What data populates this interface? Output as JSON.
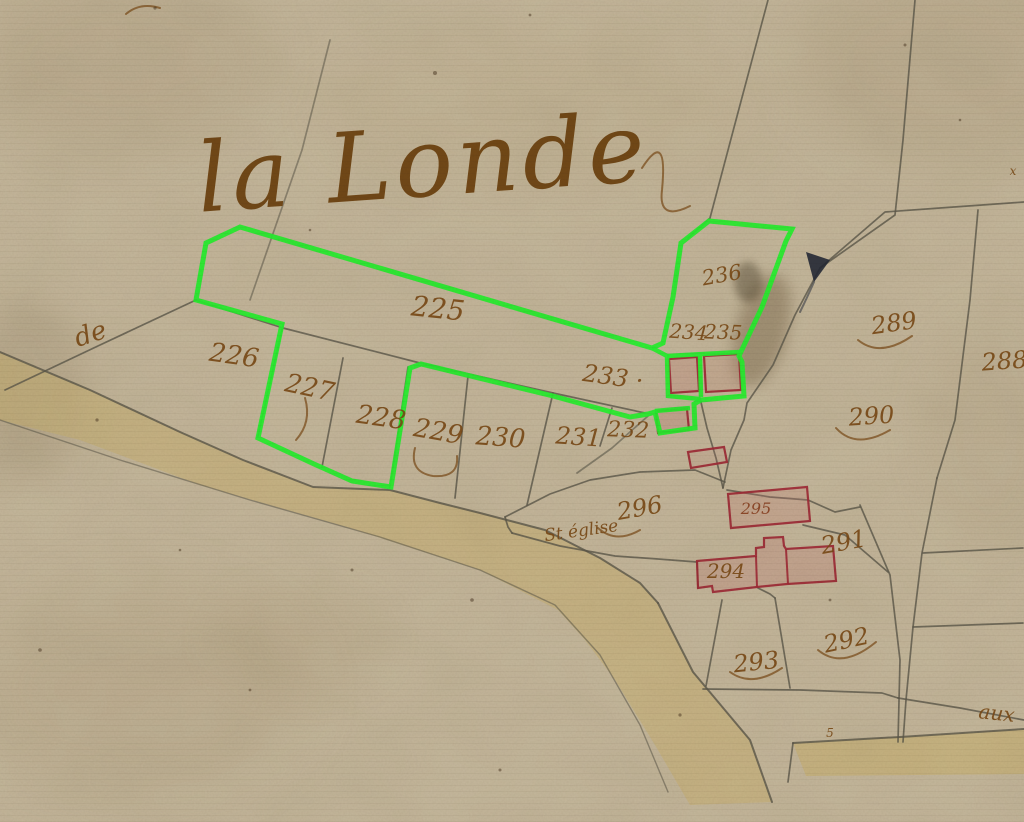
{
  "map": {
    "title": "la Londe",
    "colors": {
      "paper": "#c6b99e",
      "line": "#5c594b",
      "green": "#26f32e",
      "red": "#a12a36",
      "redFill": "#c47a74",
      "ink": "#7b4a15",
      "title_ink": "#6f4410",
      "road": "#c9b26a",
      "blot": "#252a36"
    },
    "labels": [
      {
        "id": "title",
        "text": "la Londe",
        "x": 425,
        "y": 196,
        "size": 96,
        "rot": -4,
        "color": "#6f4410",
        "cls": "lbl-title"
      },
      {
        "id": "de",
        "text": "de",
        "x": 93,
        "y": 342,
        "size": 26,
        "rot": -18
      },
      {
        "id": "p225",
        "text": "225",
        "x": 437,
        "y": 318,
        "size": 28,
        "rot": 6
      },
      {
        "id": "p226",
        "text": "226",
        "x": 233,
        "y": 364,
        "size": 26,
        "rot": 8
      },
      {
        "id": "p227",
        "text": "227",
        "x": 308,
        "y": 396,
        "size": 26,
        "rot": 12
      },
      {
        "id": "p228",
        "text": "228",
        "x": 380,
        "y": 426,
        "size": 26,
        "rot": 8
      },
      {
        "id": "p229",
        "text": "229",
        "x": 437,
        "y": 440,
        "size": 26,
        "rot": 10
      },
      {
        "id": "p230",
        "text": "230",
        "x": 500,
        "y": 446,
        "size": 26,
        "rot": 4
      },
      {
        "id": "p231",
        "text": "231",
        "x": 578,
        "y": 445,
        "size": 24,
        "rot": 4
      },
      {
        "id": "p232",
        "text": "232",
        "x": 628,
        "y": 437,
        "size": 22,
        "rot": 2
      },
      {
        "id": "p233",
        "text": "233 ·",
        "x": 612,
        "y": 385,
        "size": 24,
        "rot": 8
      },
      {
        "id": "p234",
        "text": "234",
        "x": 688,
        "y": 339,
        "size": 20,
        "rot": 4
      },
      {
        "id": "p235",
        "text": "235",
        "x": 723,
        "y": 339,
        "size": 20,
        "rot": 2
      },
      {
        "id": "p236",
        "text": "236",
        "x": 723,
        "y": 282,
        "size": 21,
        "rot": -10
      },
      {
        "id": "p288",
        "text": "288",
        "x": 1005,
        "y": 369,
        "size": 24,
        "rot": -4
      },
      {
        "id": "p289",
        "text": "289",
        "x": 895,
        "y": 331,
        "size": 24,
        "rot": -8
      },
      {
        "id": "p290",
        "text": "290",
        "x": 872,
        "y": 424,
        "size": 24,
        "rot": -4
      },
      {
        "id": "p291",
        "text": "291",
        "x": 845,
        "y": 550,
        "size": 24,
        "rot": -10
      },
      {
        "id": "p292",
        "text": "292",
        "x": 848,
        "y": 648,
        "size": 24,
        "rot": -12
      },
      {
        "id": "p293",
        "text": "293",
        "x": 757,
        "y": 670,
        "size": 24,
        "rot": -6
      },
      {
        "id": "p294",
        "text": "294",
        "x": 726,
        "y": 578,
        "size": 20,
        "rot": 0
      },
      {
        "id": "p295",
        "text": "295",
        "x": 756,
        "y": 514,
        "size": 16,
        "rot": 0,
        "color": "#8a4020"
      },
      {
        "id": "p296",
        "text": "296",
        "x": 641,
        "y": 516,
        "size": 24,
        "rot": -10
      },
      {
        "id": "eglise",
        "text": "St église",
        "x": 582,
        "y": 536,
        "size": 17,
        "rot": -8
      },
      {
        "id": "aux",
        "text": "aux",
        "x": 996,
        "y": 720,
        "size": 20,
        "rot": 6
      },
      {
        "id": "mark-5",
        "text": "5",
        "x": 830,
        "y": 737,
        "size": 12,
        "rot": 0
      },
      {
        "id": "mark-x",
        "text": "x",
        "x": 1013,
        "y": 175,
        "size": 12,
        "rot": 0
      }
    ],
    "roads": [
      {
        "id": "main-road",
        "path": "M0,352 L90,390 L180,432 L243,460 L313,487 L390,490 L440,503 L480,513 L545,530 L600,558 L640,583 L658,603 L693,672 L750,740 L772,802 L690,805 L655,745 L615,680 L585,640 L558,610 L480,570 L350,528 L200,485 L80,440 L0,420 Z",
        "op": 0.45
      },
      {
        "id": "bottom-right-road",
        "path": "M793,743 L900,737 L1024,729 L1024,774 L806,776 Z",
        "op": 0.5
      }
    ],
    "boundaries": [
      {
        "id": "curve-behind-title",
        "pts": "330,40 302,150 268,248 250,300",
        "o": 0.55
      },
      {
        "pts": "768,0 736,120 710,218 688,238"
      },
      {
        "pts": "915,0 903,140 895,215 820,268"
      },
      {
        "pts": "1024,202 940,208 885,212 820,268"
      },
      {
        "pts": "978,210 970,300 955,420 937,478"
      },
      {
        "pts": "937,478 922,553 913,627 906,700 903,742"
      },
      {
        "pts": "860,505 890,575 900,660 898,742"
      },
      {
        "pts": "820,268 795,315 773,365 747,403 744,420 731,450 723,488"
      },
      {
        "pts": "700,398 707,428 716,458 723,488"
      },
      {
        "pts": "727,490 770,497 808,500 835,512 860,507"
      },
      {
        "pts": "803,525 845,535 888,572"
      },
      {
        "pts": "195,300 283,328 420,363 553,393 645,413"
      },
      {
        "pts": "196,300 100,345 5,390"
      },
      {
        "pts": "343,358 322,467"
      },
      {
        "pts": "408,367 390,487"
      },
      {
        "pts": "468,376 455,498"
      },
      {
        "pts": "553,393 527,505"
      },
      {
        "pts": "612,408 600,446"
      },
      {
        "id": "road-upper-edge",
        "pts": "0,352 90,390 180,432 243,460 313,487 390,490 440,503 480,513 545,530 600,558 640,583 658,603",
        "w": 2
      },
      {
        "id": "road-south-east-edge",
        "pts": "658,603 693,672 750,740 772,802",
        "w": 2
      },
      {
        "id": "road-lower-edge",
        "pts": "0,420 120,460 250,500 380,537 480,570 555,605 600,655 640,725 668,792",
        "w": 1.4,
        "o": 0.55
      },
      {
        "id": "br-road-north-edge",
        "pts": "793,743 900,737 1024,729",
        "w": 2
      },
      {
        "pts": "793,743 788,782"
      },
      {
        "pts": "898,698 960,708 1024,720"
      },
      {
        "pts": "505,517 550,494 590,480 640,472 695,470 725,482"
      },
      {
        "pts": "512,533 560,546 615,556 658,559 697,562"
      },
      {
        "pts": "505,517 508,527 512,533"
      },
      {
        "pts": "722,600 706,686"
      },
      {
        "pts": "775,598 790,688"
      },
      {
        "pts": "703,689 800,690 882,693 898,698"
      },
      {
        "pts": "923,553 1023,548"
      },
      {
        "pts": "913,627 1023,623"
      },
      {
        "pts": "758,588 770,594 775,598"
      },
      {
        "pts": "697,562 698,588"
      },
      {
        "pts": "283,325 258,436"
      },
      {
        "pts": "648,416 612,448 577,473",
        "o": 0.6
      }
    ],
    "buildings": [
      {
        "name": "building-234",
        "pts": "669,359 697,357 699,391 671,393",
        "fill": 0.3
      },
      {
        "name": "building-235",
        "pts": "704,356 739,354 741,390 706,392",
        "fill": 0.22
      },
      {
        "name": "building-232",
        "pts": "656,411 687,409 689,430 658,433",
        "fill": 0.3
      },
      {
        "name": "building-lane-small",
        "pts": "688,452 724,447 727,462 691,468",
        "fill": 0.15
      },
      {
        "name": "building-295",
        "pts": "728,494 807,487 810,521 731,528",
        "fill": 0.28
      },
      {
        "name": "building-294-complex",
        "path": "M697,561 L756,556 L756,548 L764,547 L764,538 L783,537 L784,546 L786,549 L833,546 L836,581 L787,584 L757,587 L713,592 L712,586 L698,588 Z",
        "fill": 0.3,
        "segs": [
          "756,556 757,587",
          "786,549 788,584"
        ]
      }
    ],
    "green": {
      "loop": "282,324 196,300 206,243 240,227 652,348 663,343 673,297 681,243 709,221 792,229 786,241 762,307 739,356 742,362 744,396 701,400 694,404 695,428 660,433 655,412 648,414 630,417 553,396 421,364 410,368 391,487 352,481 314,464 258,438",
      "segs": [
        "652,348 667,356 668,396 700,399",
        "700,356 701,397",
        "667,356 740,352",
        "655,411 690,408"
      ]
    },
    "ink_marks": {
      "blot_path": "M806,252 L830,260 L814,282 Z",
      "blot_tail": "M814,282 Q806,300 800,312"
    },
    "flourishes": [
      "M642,168 Q668,128 662,190 Q658,222 690,206",
      "M126,14 Q140,2 160,8",
      "M858,340 Q880,358 912,336",
      "M836,428 Q856,450 890,430",
      "M818,650 Q842,670 876,642",
      "M730,672 Q752,688 782,668",
      "M598,528 Q616,544 640,530",
      "M305,398 Q312,422 296,440",
      "M415,448 Q409,472 433,476 Q459,478 457,456"
    ],
    "stains": [
      {
        "cx": 762,
        "cy": 330,
        "rx": 26,
        "ry": 58,
        "rot": 15,
        "color": "#4a3214",
        "op": 0.28,
        "blur": 7
      },
      {
        "cx": 748,
        "cy": 282,
        "rx": 14,
        "ry": 20,
        "rot": 0,
        "color": "#2e2410",
        "op": 0.35,
        "blur": 4
      },
      {
        "cx": 120,
        "cy": 60,
        "rx": 150,
        "ry": 90,
        "rot": 0,
        "color": "#8a734f",
        "op": 0.12,
        "blur": 28
      },
      {
        "cx": 950,
        "cy": 60,
        "rx": 160,
        "ry": 100,
        "rot": 0,
        "color": "#8a734f",
        "op": 0.12,
        "blur": 28
      },
      {
        "cx": 140,
        "cy": 690,
        "rx": 170,
        "ry": 110,
        "rot": 0,
        "color": "#97805c",
        "op": 0.12,
        "blur": 30
      },
      {
        "cx": 540,
        "cy": 110,
        "rx": 220,
        "ry": 80,
        "rot": 0,
        "color": "#b29a6e",
        "op": 0.1,
        "blur": 28
      },
      {
        "cx": 300,
        "cy": 640,
        "rx": 90,
        "ry": 55,
        "rot": 0,
        "color": "#8f7850",
        "op": 0.09,
        "blur": 20
      },
      {
        "cx": 25,
        "cy": 390,
        "rx": 60,
        "ry": 90,
        "rot": 0,
        "color": "#6e5836",
        "op": 0.14,
        "blur": 18
      },
      {
        "cx": 990,
        "cy": 430,
        "rx": 70,
        "ry": 120,
        "rot": 0,
        "color": "#8a734f",
        "op": 0.08,
        "blur": 22
      }
    ],
    "specks": [
      [
        155,
        8,
        1.6
      ],
      [
        435,
        73,
        2
      ],
      [
        530,
        15,
        1.4
      ],
      [
        97,
        420,
        1.6
      ],
      [
        40,
        650,
        1.8
      ],
      [
        352,
        570,
        1.5
      ],
      [
        500,
        770,
        1.5
      ],
      [
        250,
        690,
        1.4
      ],
      [
        905,
        45,
        1.5
      ],
      [
        960,
        120,
        1.3
      ],
      [
        310,
        230,
        1.3
      ],
      [
        680,
        715,
        1.6
      ],
      [
        180,
        550,
        1.3
      ],
      [
        472,
        600,
        1.8
      ],
      [
        830,
        600,
        1.4
      ]
    ]
  }
}
